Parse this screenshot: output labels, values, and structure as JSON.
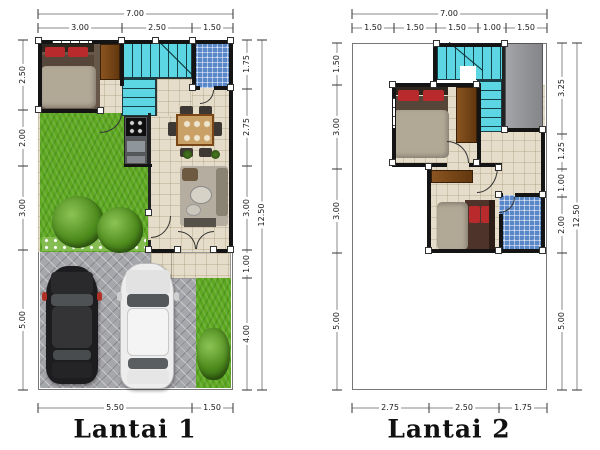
{
  "plans": [
    {
      "id": "lantai-1",
      "title": "Lantai 1",
      "dims": {
        "top_total": "7.00",
        "top": [
          "3.00",
          "2.50",
          "1.50"
        ],
        "left": [
          "2.50",
          "2.00",
          "3.00",
          "5.00"
        ],
        "right": [
          "1.75",
          "2.75",
          "3.00",
          "1.00",
          "4.00"
        ],
        "right_total": "12.50",
        "bottom": [
          "5.50",
          "1.50"
        ]
      }
    },
    {
      "id": "lantai-2",
      "title": "Lantai 2",
      "dims": {
        "top_total": "7.00",
        "top": [
          "1.50",
          "1.50",
          "1.50",
          "1.00",
          "1.50"
        ],
        "left": [
          "1.50",
          "3.00",
          "3.00",
          "5.00"
        ],
        "right": [
          "3.25",
          "1.25",
          "1.00",
          "2.00",
          "5.00"
        ],
        "right_total": "12.50",
        "bottom": [
          "2.75",
          "2.50",
          "1.75"
        ]
      }
    }
  ],
  "colors": {
    "wall": "#141414",
    "dim_text": "#1a1a1a",
    "title_text": "#111111",
    "stairs_cyan": "#5cd6e2",
    "bathroom_blue": "#5a87c8",
    "tile_beige": "#e5ddc9",
    "grass_green": "#5da820",
    "paving_gray": "#a6a7ab",
    "slab_gray": "#9b9b9d",
    "wood_brown": "#7a4616",
    "bed_blanket": "#b2a896",
    "pillow_red": "#b92a2c",
    "car_black": "#1d1d1f",
    "car_white": "#ededed"
  }
}
